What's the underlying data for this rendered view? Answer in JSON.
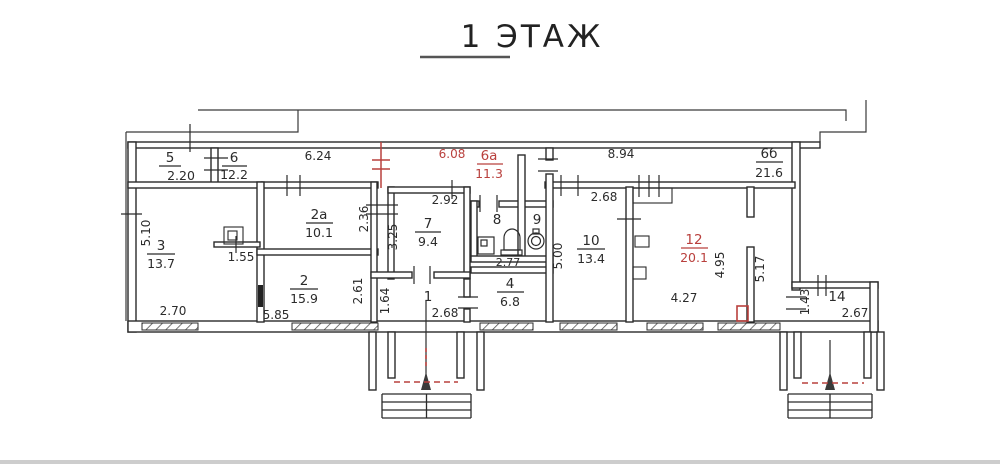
{
  "title": "1 ЭТАЖ",
  "colors": {
    "ink": "#2b2b2b",
    "red": "#b9403d",
    "footer_bar": "#cdcdcd"
  },
  "rooms": [
    {
      "num": "5",
      "value": "2.20"
    },
    {
      "num": "6",
      "value": "12.2"
    },
    {
      "num": "6а",
      "value": "11.3"
    },
    {
      "num": "6б",
      "value": "21.6"
    },
    {
      "num": "3",
      "value": "13.7"
    },
    {
      "num": "2а",
      "value": "10.1"
    },
    {
      "num": "2",
      "value": "15.9"
    },
    {
      "num": "7",
      "value": "9.4"
    },
    {
      "num": "8",
      "value": ""
    },
    {
      "num": "9",
      "value": ""
    },
    {
      "num": "1",
      "value": ""
    },
    {
      "num": "4",
      "value": "6.8"
    },
    {
      "num": "10",
      "value": "13.4"
    },
    {
      "num": "12",
      "value": "20.1"
    },
    {
      "num": "14",
      "value": ""
    }
  ],
  "dims": {
    "d624": "6.24",
    "d608": "6.08",
    "d894": "8.94",
    "d510": "5.10",
    "d270": "2.70",
    "d155": "1.55",
    "d236": "2.36",
    "d261": "2.61",
    "d585": "5.85",
    "d292": "2.92",
    "d325": "3.25",
    "d277": "2.77",
    "d164": "1.64",
    "d268a": "2.68",
    "d268b": "2.68",
    "d500": "5.00",
    "d427": "4.27",
    "d495": "4.95",
    "d517": "5.17",
    "d143": "1.43",
    "d267": "2.67"
  },
  "icons": {
    "washing_machine": "washer-symbol",
    "toilet": "toilet-symbol",
    "sink": "sink-symbol",
    "entry_arrow": "entrance-arrow"
  }
}
